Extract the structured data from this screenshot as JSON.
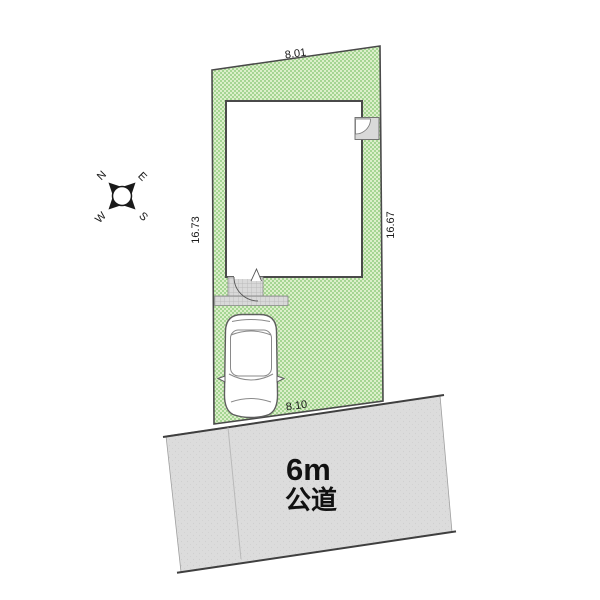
{
  "plan": {
    "title": "site-plan-diagram",
    "dimensions": {
      "top": "8.01",
      "bottom": "8.10",
      "left": "16.73",
      "right": "16.67"
    },
    "road": {
      "size": "6m",
      "type": "公道"
    },
    "compass": {
      "n": "N",
      "e": "E",
      "s": "S",
      "w": "W"
    },
    "colors": {
      "plot_green_light": "#dcefca",
      "plot_green_dark": "#a5d593",
      "road_gray": "#dcdcdc",
      "road_dot": "#cfcfcf",
      "porch_gray": "#d9d9d9",
      "porch_grid": "#b2b2b2",
      "outline_dark": "#4a4a4a",
      "alcove_gray": "#d9d9d9"
    }
  }
}
